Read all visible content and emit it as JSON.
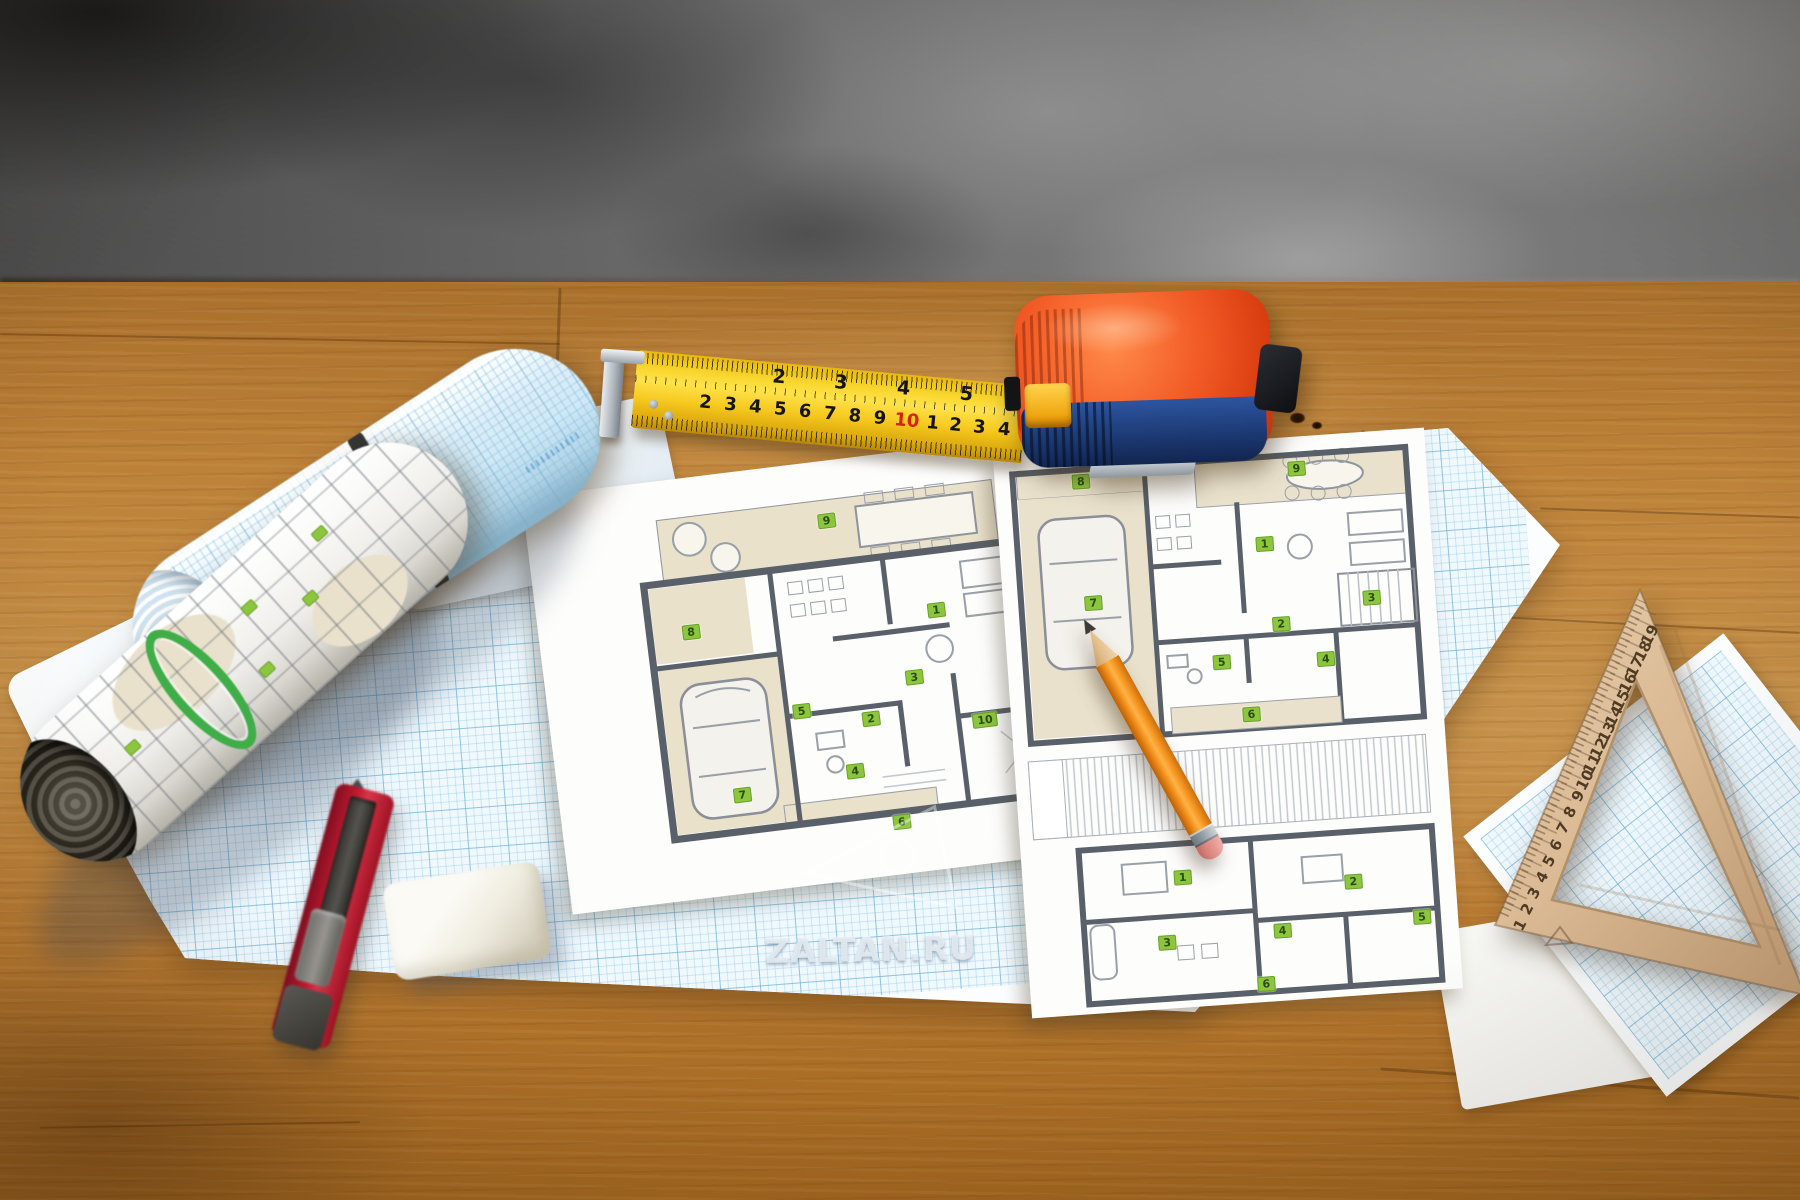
{
  "watermark": {
    "text": "ZALTAN.RU"
  },
  "tape_measure": {
    "upper_scale": [
      {
        "t": "2",
        "x": 143,
        "y": 14
      },
      {
        "t": "3",
        "x": 205,
        "y": 14
      },
      {
        "t": "4",
        "x": 268,
        "y": 14
      },
      {
        "t": "5",
        "x": 331,
        "y": 14
      }
    ],
    "lower_scale": [
      {
        "t": "2",
        "x": 72,
        "y": 46
      },
      {
        "t": "3",
        "x": 97,
        "y": 46
      },
      {
        "t": "4",
        "x": 122,
        "y": 46
      },
      {
        "t": "5",
        "x": 147,
        "y": 46
      },
      {
        "t": "6",
        "x": 172,
        "y": 46
      },
      {
        "t": "7",
        "x": 197,
        "y": 46
      },
      {
        "t": "8",
        "x": 222,
        "y": 46
      },
      {
        "t": "9",
        "x": 247,
        "y": 46
      },
      {
        "t": "10",
        "x": 274,
        "y": 46,
        "c": "#d42300"
      },
      {
        "t": "1",
        "x": 300,
        "y": 46
      },
      {
        "t": "2",
        "x": 323,
        "y": 46
      },
      {
        "t": "3",
        "x": 347,
        "y": 46
      },
      {
        "t": "4",
        "x": 372,
        "y": 46
      }
    ],
    "colors": {
      "blade": "#f6c91f",
      "body_top": "#e8491d",
      "body_bottom": "#1d3a74"
    }
  },
  "triangle_ruler": {
    "scale": [
      {
        "t": "1",
        "x": 1520,
        "y": 925,
        "r": -62
      },
      {
        "t": "2",
        "x": 1527,
        "y": 909,
        "r": -62
      },
      {
        "t": "3",
        "x": 1534,
        "y": 893,
        "r": -62
      },
      {
        "t": "4",
        "x": 1542,
        "y": 877,
        "r": -62
      },
      {
        "t": "5",
        "x": 1549,
        "y": 861,
        "r": -62
      },
      {
        "t": "6",
        "x": 1556,
        "y": 845,
        "r": -62
      },
      {
        "t": "7",
        "x": 1563,
        "y": 828,
        "r": -62
      },
      {
        "t": "8",
        "x": 1570,
        "y": 812,
        "r": -62
      },
      {
        "t": "9",
        "x": 1578,
        "y": 796,
        "r": -62
      },
      {
        "t": "10",
        "x": 1585,
        "y": 780,
        "r": -62
      },
      {
        "t": "11",
        "x": 1592,
        "y": 764,
        "r": -62
      },
      {
        "t": "12",
        "x": 1599,
        "y": 748,
        "r": -62
      },
      {
        "t": "13",
        "x": 1607,
        "y": 732,
        "r": -62
      },
      {
        "t": "14",
        "x": 1614,
        "y": 716,
        "r": -62
      },
      {
        "t": "15",
        "x": 1621,
        "y": 700,
        "r": -62
      },
      {
        "t": "16",
        "x": 1628,
        "y": 683,
        "r": -62
      },
      {
        "t": "17",
        "x": 1635,
        "y": 667,
        "r": -62
      },
      {
        "t": "18",
        "x": 1643,
        "y": 651,
        "r": -62
      },
      {
        "t": "19",
        "x": 1650,
        "y": 635,
        "r": -62
      }
    ]
  },
  "center_plan": {
    "labels": [
      {
        "t": "9",
        "x": 300,
        "y": 60
      },
      {
        "t": "8",
        "x": 152,
        "y": 154
      },
      {
        "t": "1",
        "x": 398,
        "y": 162
      },
      {
        "t": "3",
        "x": 368,
        "y": 226
      },
      {
        "t": "5",
        "x": 252,
        "y": 246
      },
      {
        "t": "2",
        "x": 320,
        "y": 262
      },
      {
        "t": "4",
        "x": 298,
        "y": 312
      },
      {
        "t": "6",
        "x": 338,
        "y": 368
      },
      {
        "t": "7",
        "x": 183,
        "y": 322
      },
      {
        "t": "10",
        "x": 433,
        "y": 277
      }
    ]
  },
  "right_sheet": {
    "floor1_labels": [
      {
        "t": "8",
        "x": 86,
        "y": 30
      },
      {
        "t": "9",
        "x": 302,
        "y": 32
      },
      {
        "t": "7",
        "x": 90,
        "y": 152
      },
      {
        "t": "1",
        "x": 265,
        "y": 105
      },
      {
        "t": "2",
        "x": 276,
        "y": 186
      },
      {
        "t": "3",
        "x": 368,
        "y": 166
      },
      {
        "t": "4",
        "x": 318,
        "y": 224
      },
      {
        "t": "5",
        "x": 214,
        "y": 220
      },
      {
        "t": "6",
        "x": 240,
        "y": 274
      }
    ],
    "floor2_labels": [
      {
        "t": "1",
        "x": 160,
        "y": 432
      },
      {
        "t": "2",
        "x": 330,
        "y": 448
      },
      {
        "t": "3",
        "x": 140,
        "y": 496
      },
      {
        "t": "4",
        "x": 256,
        "y": 492
      },
      {
        "t": "5",
        "x": 396,
        "y": 488
      },
      {
        "t": "6",
        "x": 236,
        "y": 544
      }
    ]
  },
  "palette": {
    "label_green": "#8cc63e",
    "wall_gray": "#5a616b",
    "paper_beige": "#e9e1cc",
    "grid_blue": "#6eafd7",
    "wood_desk": "#b5772f"
  }
}
